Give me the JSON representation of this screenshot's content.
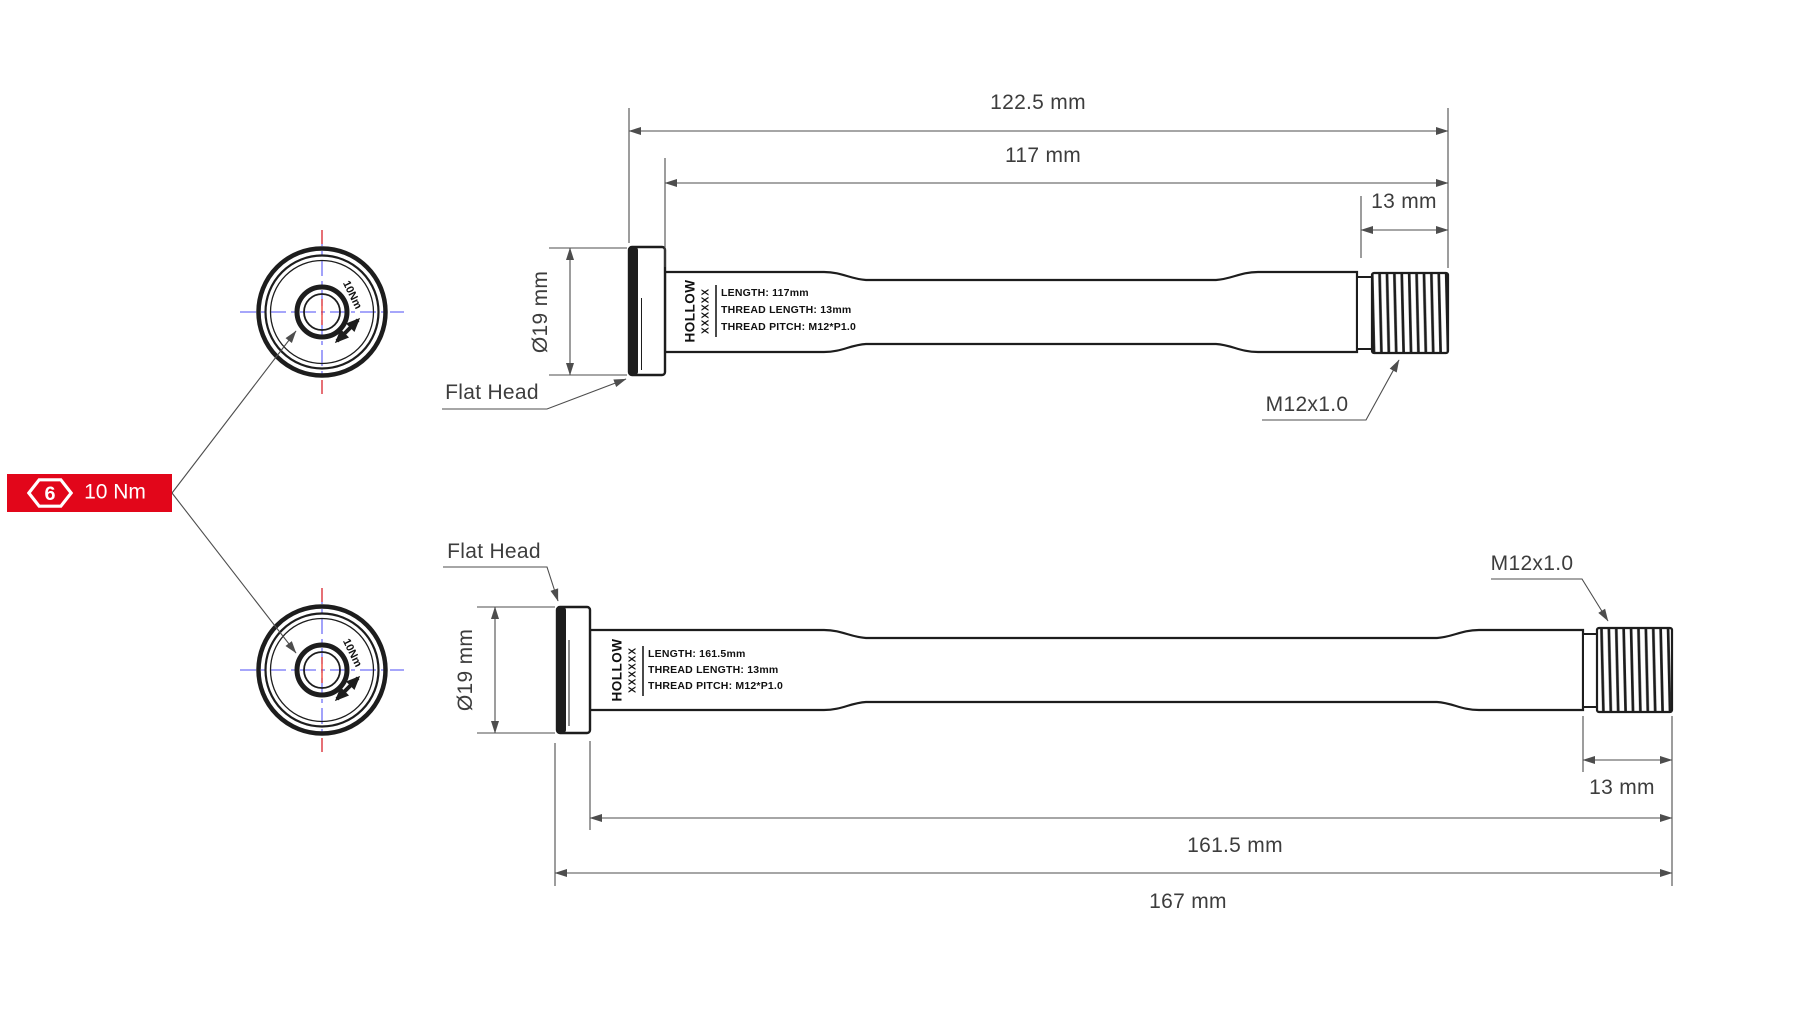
{
  "colors": {
    "accent_red": "#e2061a",
    "centerline_blue": "#7070f8",
    "centerline_red": "#ef3b2d",
    "line_dark": "#1d1d1d",
    "dim_gray": "#4d4d4d",
    "text_gray": "#3d3d3d"
  },
  "badge": {
    "hex_number": "6",
    "torque_label": "10 Nm"
  },
  "hub_view_top": {
    "torque_print": "10Nm"
  },
  "hub_view_bottom": {
    "torque_print": "10Nm"
  },
  "axle_top": {
    "dim_overall": "122.5 mm",
    "dim_length": "117 mm",
    "dim_thread": "13 mm",
    "dim_head_diameter": "Ø19 mm",
    "label_head": "Flat Head",
    "label_thread": "M12x1.0",
    "print_brand": "HOLLOW",
    "print_model": "XXXXXX",
    "print_line1": "LENGTH: 117mm",
    "print_line2": "THREAD LENGTH: 13mm",
    "print_line3": "THREAD PITCH: M12*P1.0"
  },
  "axle_bottom": {
    "dim_overall": "167 mm",
    "dim_length": "161.5 mm",
    "dim_thread": "13 mm",
    "dim_head_diameter": "Ø19 mm",
    "label_head": "Flat Head",
    "label_thread": "M12x1.0",
    "print_brand": "HOLLOW",
    "print_model": "XXXXXX",
    "print_line1": "LENGTH: 161.5mm",
    "print_line2": "THREAD LENGTH: 13mm",
    "print_line3": "THREAD PITCH: M12*P1.0"
  }
}
